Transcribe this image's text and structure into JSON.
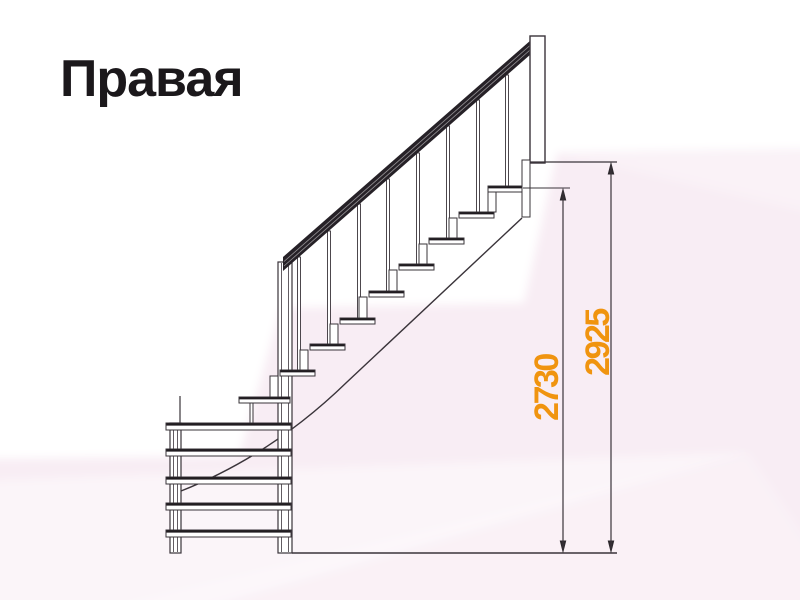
{
  "title": {
    "text": "Правая"
  },
  "colors": {
    "bg": "#f8edf4",
    "ink": "#3a343a",
    "ink_dark": "#201c20",
    "rail": "#262127",
    "accent": "#F0940F",
    "arrow": "#2c282c",
    "title": "#1b181b"
  },
  "dims": [
    {
      "label": "2730"
    },
    {
      "label": "2925"
    }
  ],
  "layers": [
    {
      "name": "background",
      "rects": [
        {
          "n": "bg-base",
          "x": -20,
          "y": -20,
          "w": 840,
          "h": 640,
          "fill": "#f8edf4",
          "stroke": "none"
        }
      ],
      "polys": [
        {
          "n": "bg-white-region",
          "pts": "-20,-20 820,-20 820,149 557,153 524,303 281,308 239,456 -20,459",
          "fill": "#ffffff",
          "blur": 1
        },
        {
          "n": "bg-facet-light",
          "pts": "-20,481 748,452 160,620 -20,620",
          "fill": "rgba(255,255,255,0.45)",
          "blur": 1
        },
        {
          "n": "bg-facet-faint",
          "pts": "748,452 820,560 820,620 60,620",
          "fill": "rgba(255,255,255,0.22)",
          "blur": 1
        },
        {
          "n": "bg-facet-top-right",
          "pts": "557,153 820,146 820,215",
          "fill": "rgba(255,255,255,0.25)",
          "blur": 1
        }
      ]
    },
    {
      "name": "stringer",
      "paths": [
        {
          "n": "stringer-line",
          "d": "M 522 218 L 347 382 Q 272 455 181 491",
          "sw": 1.4
        }
      ]
    },
    {
      "name": "posts",
      "rects": [
        {
          "n": "newel-post",
          "x": 278,
          "y": 262,
          "w": 14,
          "h": 291,
          "sw": 1.2
        },
        {
          "n": "winder-left-post",
          "x": 170,
          "y": 423,
          "w": 11,
          "h": 130,
          "sw": 1.2
        }
      ],
      "lines": [
        {
          "n": "newel-post-inner-edge",
          "x1": 281.5,
          "y1": 263,
          "x2": 281.5,
          "y2": 552,
          "sw": 0.8
        },
        {
          "n": "newel-post-inner-edge",
          "x1": 288.5,
          "y1": 263,
          "x2": 288.5,
          "y2": 552,
          "sw": 0.8
        },
        {
          "n": "left-post-inner-edge",
          "x1": 173.5,
          "y1": 424,
          "x2": 173.5,
          "y2": 552,
          "sw": 0.8
        },
        {
          "n": "left-post-inner-edge",
          "x1": 177.5,
          "y1": 424,
          "x2": 177.5,
          "y2": 552,
          "sw": 0.8
        },
        {
          "n": "left-post-top-stub",
          "x1": 180,
          "y1": 396,
          "x2": 180,
          "y2": 423,
          "sw": 1.2
        }
      ]
    },
    {
      "name": "balusters",
      "rects": [
        {
          "n": "baluster",
          "x": 505.5,
          "y": 75,
          "w": 3,
          "h": 111,
          "sw": 0.9
        },
        {
          "n": "baluster",
          "x": 476.5,
          "y": 100,
          "w": 3,
          "h": 112,
          "sw": 0.9
        },
        {
          "n": "baluster",
          "x": 446.5,
          "y": 126,
          "w": 3,
          "h": 112,
          "sw": 0.9
        },
        {
          "n": "baluster",
          "x": 416.5,
          "y": 153,
          "w": 3,
          "h": 111,
          "sw": 0.9
        },
        {
          "n": "baluster",
          "x": 386.5,
          "y": 179,
          "w": 3,
          "h": 112,
          "sw": 0.9
        },
        {
          "n": "baluster",
          "x": 357.5,
          "y": 204,
          "w": 3,
          "h": 114,
          "sw": 0.9
        },
        {
          "n": "baluster",
          "x": 327.5,
          "y": 231,
          "w": 3,
          "h": 113,
          "sw": 0.9
        },
        {
          "n": "baluster",
          "x": 297.5,
          "y": 257,
          "w": 3,
          "h": 113,
          "sw": 0.9
        }
      ]
    },
    {
      "name": "risers",
      "rects": [
        {
          "n": "riser-support",
          "x": 488,
          "y": 192,
          "w": 8,
          "h": 20,
          "sw": 1
        },
        {
          "n": "riser-support",
          "x": 449,
          "y": 218,
          "w": 8,
          "h": 20,
          "sw": 1
        },
        {
          "n": "riser-support",
          "x": 419,
          "y": 244,
          "w": 8,
          "h": 20,
          "sw": 1
        },
        {
          "n": "riser-support",
          "x": 389,
          "y": 270,
          "w": 8,
          "h": 21,
          "sw": 1
        },
        {
          "n": "riser-support",
          "x": 359,
          "y": 297,
          "w": 8,
          "h": 21,
          "sw": 1
        },
        {
          "n": "riser-support",
          "x": 330,
          "y": 324,
          "w": 8,
          "h": 20,
          "sw": 1
        },
        {
          "n": "riser-support",
          "x": 300,
          "y": 350,
          "w": 8,
          "h": 20,
          "sw": 1
        },
        {
          "n": "riser-support",
          "x": 270,
          "y": 376,
          "w": 8,
          "h": 21,
          "sw": 1
        },
        {
          "n": "winder-tread-support",
          "x": 250,
          "y": 403,
          "w": 3,
          "h": 20,
          "sw": 1
        }
      ]
    },
    {
      "name": "treads",
      "rects": [
        {
          "n": "tread",
          "x": 488,
          "y": 186,
          "w": 35,
          "h": 6,
          "sw": 1
        },
        {
          "n": "tread",
          "x": 459,
          "y": 212,
          "w": 35,
          "h": 6,
          "sw": 1
        },
        {
          "n": "tread",
          "x": 429,
          "y": 238,
          "w": 35,
          "h": 6,
          "sw": 1
        },
        {
          "n": "tread",
          "x": 399,
          "y": 264,
          "w": 35,
          "h": 6,
          "sw": 1
        },
        {
          "n": "tread",
          "x": 369,
          "y": 291,
          "w": 35,
          "h": 6,
          "sw": 1
        },
        {
          "n": "tread",
          "x": 340,
          "y": 318,
          "w": 35,
          "h": 6,
          "sw": 1
        },
        {
          "n": "tread",
          "x": 310,
          "y": 344,
          "w": 35,
          "h": 6,
          "sw": 1
        },
        {
          "n": "tread",
          "x": 280,
          "y": 370,
          "w": 35,
          "h": 6,
          "sw": 1
        },
        {
          "n": "winder-tread",
          "x": 239,
          "y": 397,
          "w": 51,
          "h": 6,
          "sw": 1
        },
        {
          "n": "winder-tread",
          "x": 166,
          "y": 423,
          "w": 125,
          "h": 7,
          "sw": 1
        },
        {
          "n": "winder-tread",
          "x": 166,
          "y": 449,
          "w": 125,
          "h": 7,
          "sw": 1
        },
        {
          "n": "winder-tread",
          "x": 166,
          "y": 477,
          "w": 125,
          "h": 7,
          "sw": 1
        },
        {
          "n": "winder-tread",
          "x": 166,
          "y": 503,
          "w": 125,
          "h": 7,
          "sw": 1
        },
        {
          "n": "winder-tread",
          "x": 166,
          "y": 530,
          "w": 125,
          "h": 7,
          "sw": 1
        }
      ],
      "lines": [
        {
          "n": "tread-top-edge",
          "x1": 488.5,
          "y1": 187.3,
          "x2": 522.5,
          "y2": 187.3,
          "sw": 2.2,
          "dark": 1
        },
        {
          "n": "tread-top-edge",
          "x1": 459.5,
          "y1": 213.3,
          "x2": 493.5,
          "y2": 213.3,
          "sw": 2.2,
          "dark": 1
        },
        {
          "n": "tread-top-edge",
          "x1": 429.5,
          "y1": 239.3,
          "x2": 463.5,
          "y2": 239.3,
          "sw": 2.2,
          "dark": 1
        },
        {
          "n": "tread-top-edge",
          "x1": 399.5,
          "y1": 265.3,
          "x2": 433.5,
          "y2": 265.3,
          "sw": 2.2,
          "dark": 1
        },
        {
          "n": "tread-top-edge",
          "x1": 369.5,
          "y1": 292.3,
          "x2": 403.5,
          "y2": 292.3,
          "sw": 2.2,
          "dark": 1
        },
        {
          "n": "tread-top-edge",
          "x1": 340.5,
          "y1": 319.3,
          "x2": 374.5,
          "y2": 319.3,
          "sw": 2.2,
          "dark": 1
        },
        {
          "n": "tread-top-edge",
          "x1": 310.5,
          "y1": 345.3,
          "x2": 344.5,
          "y2": 345.3,
          "sw": 2.2,
          "dark": 1
        },
        {
          "n": "tread-top-edge",
          "x1": 280.5,
          "y1": 371.3,
          "x2": 314.5,
          "y2": 371.3,
          "sw": 2.2,
          "dark": 1
        },
        {
          "n": "tread-top-edge",
          "x1": 239.5,
          "y1": 398.3,
          "x2": 289.5,
          "y2": 398.3,
          "sw": 2.2,
          "dark": 1
        },
        {
          "n": "tread-top-edge",
          "x1": 166.5,
          "y1": 424.4,
          "x2": 290.5,
          "y2": 424.4,
          "sw": 2.4,
          "dark": 1
        },
        {
          "n": "tread-top-edge",
          "x1": 166.5,
          "y1": 450.4,
          "x2": 290.5,
          "y2": 450.4,
          "sw": 2.4,
          "dark": 1
        },
        {
          "n": "tread-top-edge",
          "x1": 166.5,
          "y1": 478.4,
          "x2": 290.5,
          "y2": 478.4,
          "sw": 2.4,
          "dark": 1
        },
        {
          "n": "tread-top-edge",
          "x1": 166.5,
          "y1": 504.4,
          "x2": 290.5,
          "y2": 504.4,
          "sw": 2.4,
          "dark": 1
        },
        {
          "n": "tread-top-edge",
          "x1": 166.5,
          "y1": 531.4,
          "x2": 290.5,
          "y2": 531.4,
          "sw": 2.4,
          "dark": 1
        }
      ]
    },
    {
      "name": "handrail",
      "polys": [
        {
          "n": "handrail",
          "pts": "283,257 531,40 531,54 283,271",
          "fill": "#262127"
        }
      ],
      "lines": [
        {
          "n": "handrail-stripe",
          "x1": 284,
          "y1": 261.5,
          "x2": 530,
          "y2": 45.5,
          "sw": 0.8,
          "stroke": "rgba(255,255,255,0.5)"
        },
        {
          "n": "handrail-stripe",
          "x1": 284,
          "y1": 266,
          "x2": 530,
          "y2": 50,
          "sw": 0.8,
          "stroke": "rgba(255,255,255,0.5)"
        }
      ]
    },
    {
      "name": "landing",
      "rects": [
        {
          "n": "top-post",
          "x": 530,
          "y": 36,
          "w": 15,
          "h": 127,
          "sw": 1.4
        },
        {
          "n": "landing-fascia",
          "x": 522,
          "y": 160,
          "w": 8,
          "h": 57,
          "sw": 1
        }
      ],
      "lines": [
        {
          "n": "landing-floor-line",
          "x1": 530,
          "y1": 162,
          "x2": 617,
          "y2": 162,
          "sw": 1.2
        },
        {
          "n": "ground-floor-line",
          "x1": 292,
          "y1": 553,
          "x2": 617,
          "y2": 553,
          "sw": 1.5
        }
      ]
    },
    {
      "name": "dimensions",
      "lines": [
        {
          "n": "dim-ext-line-2730",
          "x1": 523,
          "y1": 188,
          "x2": 570,
          "y2": 188,
          "sw": 1
        },
        {
          "n": "dim-line-2730",
          "x1": 563,
          "y1": 191,
          "x2": 563,
          "y2": 550,
          "sw": 1.2
        },
        {
          "n": "dim-line-2925",
          "x1": 611,
          "y1": 165,
          "x2": 611,
          "y2": 550,
          "sw": 1.2
        }
      ],
      "polys": [
        {
          "n": "dim-arrow-up",
          "pts": "563,187.5 559.7,200.5 566.3,200.5",
          "fill": "#2c282c"
        },
        {
          "n": "dim-arrow-down",
          "pts": "563,553.5 559.7,540.5 566.3,540.5",
          "fill": "#2c282c"
        },
        {
          "n": "dim-arrow-up",
          "pts": "611,161.5 607.7,174.5 614.3,174.5",
          "fill": "#2c282c"
        },
        {
          "n": "dim-arrow-down",
          "pts": "611,553.5 607.7,540.5 614.3,540.5",
          "fill": "#2c282c"
        }
      ],
      "texts": [
        {
          "n": "dim-label-2730",
          "x": 547,
          "y": 388,
          "rot": -90,
          "size": 34,
          "ls": -2.5,
          "bind": "dims.0.label"
        },
        {
          "n": "dim-label-2925",
          "x": 598,
          "y": 343,
          "rot": -90,
          "size": 34,
          "ls": -2.5,
          "bind": "dims.1.label"
        }
      ]
    }
  ]
}
